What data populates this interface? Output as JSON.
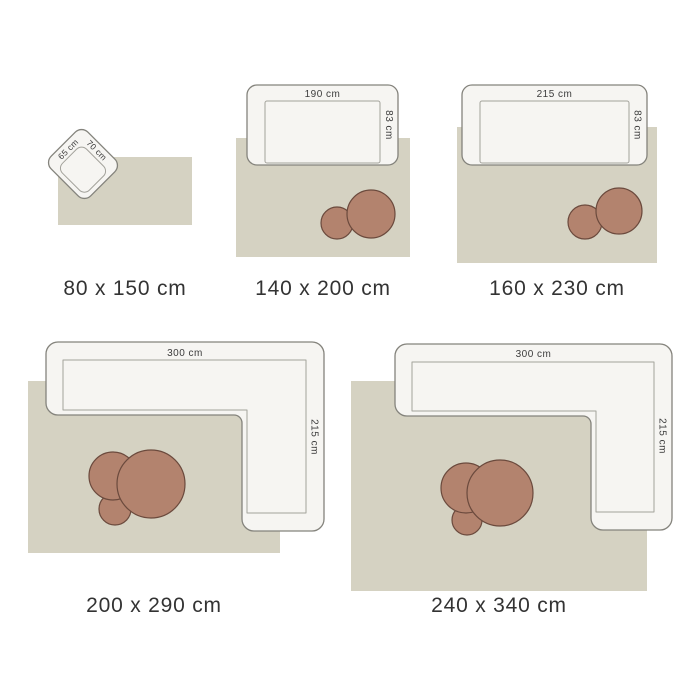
{
  "colors": {
    "background": "#ffffff",
    "rug": "#d5d2c2",
    "furniture_fill": "#f6f5f2",
    "furniture_stroke": "#84837c",
    "seat_line": "#a3a29b",
    "table_fill": "#b3836e",
    "table_stroke": "#6b4a3d",
    "dimension_text": "#3c3c3c",
    "caption_text": "#333333"
  },
  "sizes": [
    {
      "caption": "80 x 150 cm",
      "furniture": {
        "type": "armchair",
        "width_label": "65 cm",
        "depth_label": "70 cm"
      },
      "table_count": 0
    },
    {
      "caption": "140 x 200 cm",
      "furniture": {
        "type": "sofa",
        "width_label": "190 cm",
        "depth_label": "83 cm"
      },
      "table_count": 2
    },
    {
      "caption": "160 x 230 cm",
      "furniture": {
        "type": "sofa",
        "width_label": "215 cm",
        "depth_label": "83 cm"
      },
      "table_count": 2
    },
    {
      "caption": "200 x 290 cm",
      "furniture": {
        "type": "corner-sofa",
        "width_label": "300 cm",
        "depth_label": "215 cm"
      },
      "table_count": 3
    },
    {
      "caption": "240 x 340 cm",
      "furniture": {
        "type": "corner-sofa",
        "width_label": "300 cm",
        "depth_label": "215 cm"
      },
      "table_count": 3
    }
  ]
}
